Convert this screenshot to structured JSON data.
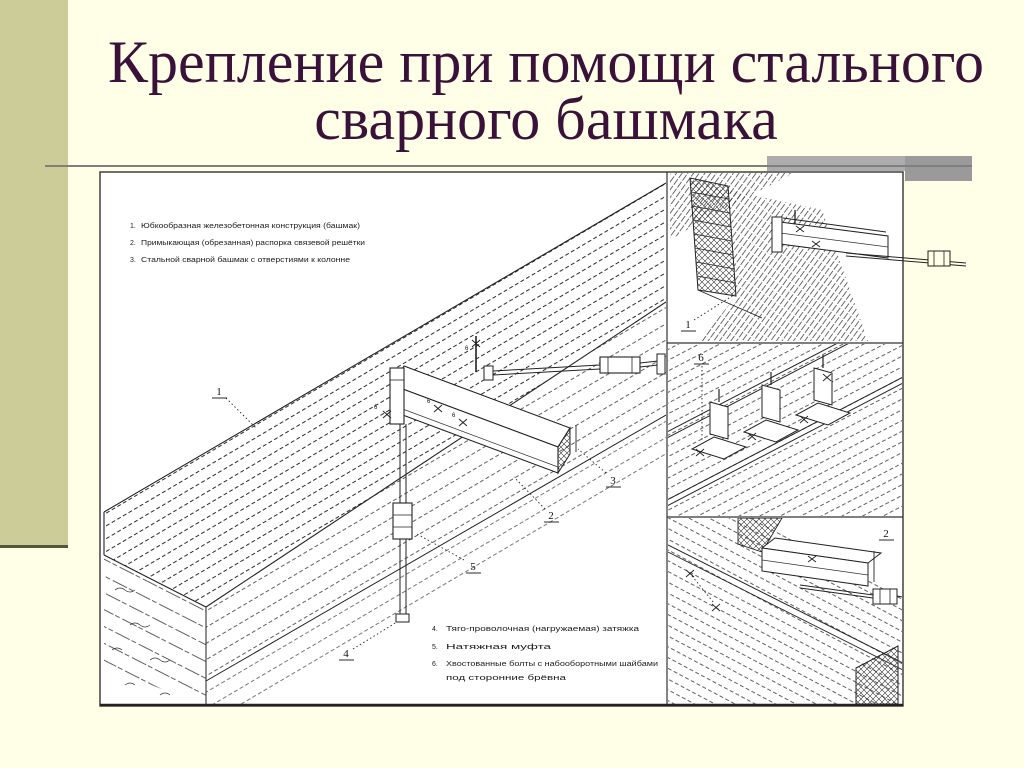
{
  "slide": {
    "title_line1": "Крепление при помощи стального",
    "title_line2": "сварного башмака"
  },
  "figure": {
    "legend_top": [
      {
        "num": "1.",
        "text": "Юбкообразная железобетонная конструкция (башмак)"
      },
      {
        "num": "2.",
        "text": "Примыкающая (обрезанная) распорка связевой решётки"
      },
      {
        "num": "3.",
        "text": "Стальной сварной башмак с отверстиями к колонне"
      }
    ],
    "legend_bottom": [
      {
        "num": "4.",
        "text": "Тяго-проволочная (нагружаемая) затяжка"
      },
      {
        "num": "5.",
        "text": "Натяжная муфта"
      },
      {
        "num": "6.",
        "text": "Хвостованные болты с набооборотными шайбами",
        "text2": "под сторонние брёвна"
      }
    ],
    "callouts": {
      "main1": "1",
      "main2": "2",
      "main3": "3",
      "main4": "4",
      "main5": "5",
      "bolt": "6",
      "panelA": "1",
      "panelB": "6",
      "panelC": "2"
    }
  },
  "colors": {
    "background": "#FFFFE7",
    "sidebar": "#CCCC99",
    "title_text": "#3A1139",
    "rule_gray": "#7F7F7F",
    "bar_gray": "#ACACAC",
    "drawing_line": "#2B2B2B",
    "canvas_white": "#FFFFFF"
  }
}
